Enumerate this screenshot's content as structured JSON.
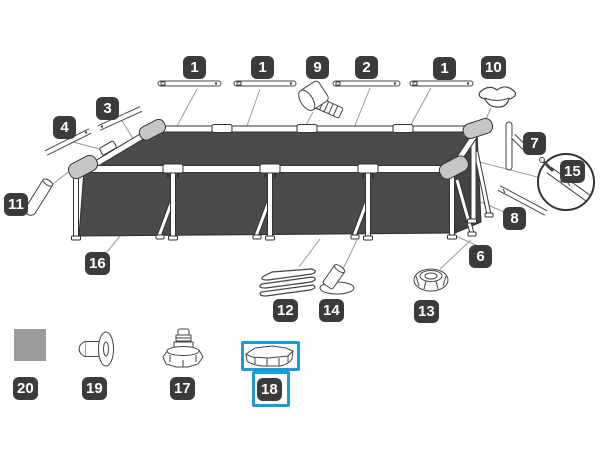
{
  "diagram": {
    "kind": "exploded parts diagram - rectangular frame pool",
    "highlight_color": "#1b9cd8",
    "selected_part_number": "18",
    "pool_fill_color": "#4a4a4a",
    "label_background_color": "#3b3b3b"
  },
  "labels": {
    "l1a": "1",
    "l1b": "1",
    "l9": "9",
    "l2": "2",
    "l1c": "1",
    "l10": "10",
    "l3": "3",
    "l4": "4",
    "l7": "7",
    "l15": "15",
    "l8": "8",
    "l11": "11",
    "l16": "16",
    "l6": "6",
    "l12": "12",
    "l14": "14",
    "l13": "13",
    "l20": "20",
    "l19": "19",
    "l17": "17",
    "l18": "18"
  }
}
